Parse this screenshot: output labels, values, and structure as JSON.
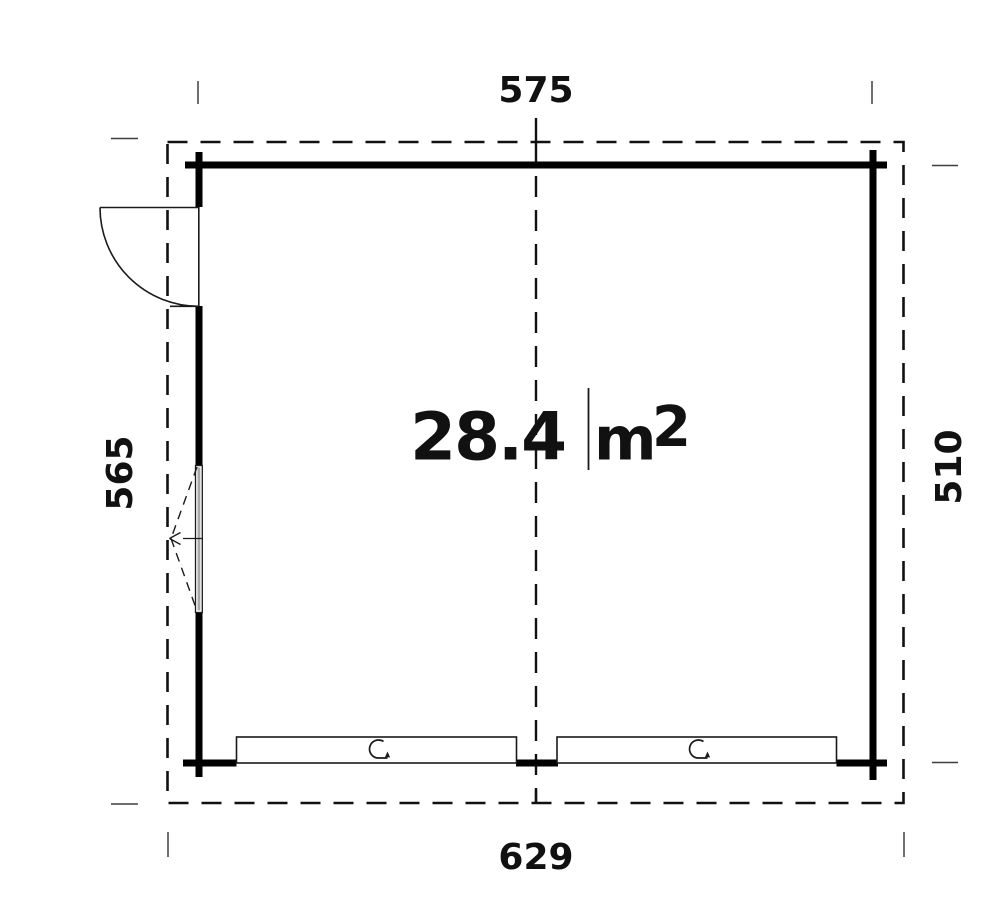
{
  "floor_plan": {
    "type": "garage-floor-plan",
    "area": {
      "value": "28.4",
      "unit": "m",
      "superscript": "2",
      "full_text": "28.4 m2"
    },
    "dimensions": {
      "top": "575",
      "bottom": "629",
      "left": "565",
      "right": "510"
    },
    "colors": {
      "wall": "#000000",
      "line": "#1a1a1a",
      "tick": "#3f3f3f",
      "window_glass": "#a8a8a8",
      "background": "#ffffff"
    },
    "icons": {
      "door": "door-swing-arc-icon",
      "window": "window-tilt-dashed-icon",
      "garage_left": "rotation-arrow-icon",
      "garage_right": "rotation-arrow-icon"
    }
  }
}
